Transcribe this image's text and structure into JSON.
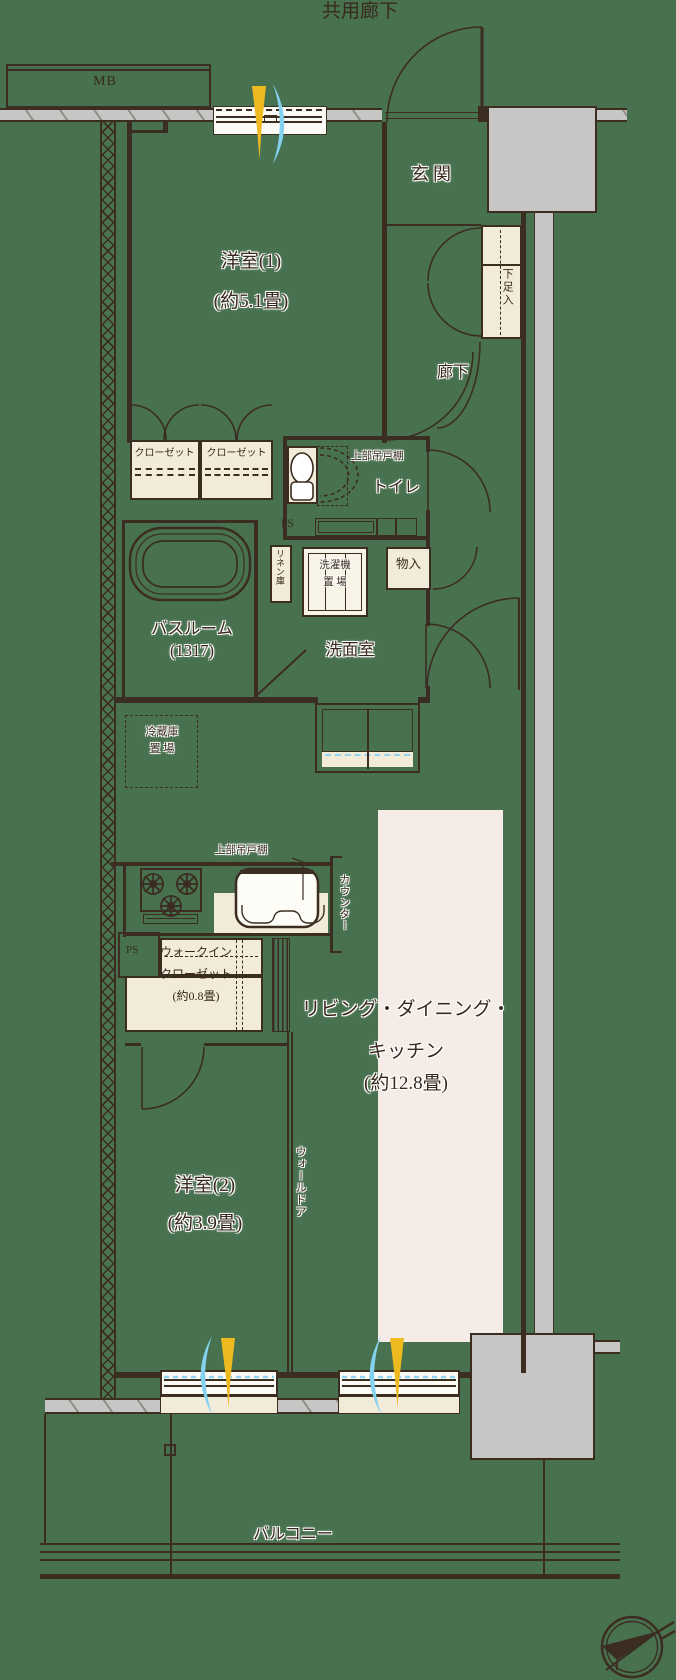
{
  "colors": {
    "background": "#48714f",
    "line": "#3b2d20",
    "cream": "#f3ebd9",
    "ldk_highlight": "#f5ebe7",
    "concrete": "#c7c6c4",
    "flame_yellow": "#efb920",
    "flame_blue": "#85d2f0"
  },
  "plan": {
    "common_corridor": "共用廊下",
    "mb": "MB",
    "entrance": "玄関",
    "shoe_cabinet": "下足入",
    "bedroom1": {
      "name": "洋室(1)",
      "size": "(約5.1畳)"
    },
    "hallway": "廊下",
    "closet_left": "クローゼット",
    "closet_right": "クローゼット",
    "toilet": {
      "upper_cabinet": "上部吊戸棚",
      "name": "トイレ"
    },
    "ps_upper": "PS",
    "linen": "リネン庫",
    "laundry": {
      "line1": "洗濯機",
      "line2": "置 場"
    },
    "storage": "物入",
    "bathroom": {
      "name": "バスルーム",
      "size": "(1317)"
    },
    "washroom": "洗面室",
    "fridge": {
      "line1": "冷蔵庫",
      "line2": "置 場"
    },
    "kitchen": {
      "upper_cabinet": "上部吊戸棚",
      "counter": "カウンター"
    },
    "ps_lower": "PS",
    "wic": {
      "line1": "ウォークイン",
      "line2": "クローゼット",
      "line3": "(約0.8畳)"
    },
    "ldk": {
      "line1": "リビング・ダイニング・",
      "line2": "キッチン",
      "line3": "(約12.8畳)"
    },
    "bedroom2": {
      "name": "洋室(2)",
      "size": "(約3.9畳)"
    },
    "wall_door": "ウォールドア",
    "balcony": "バルコニー"
  }
}
